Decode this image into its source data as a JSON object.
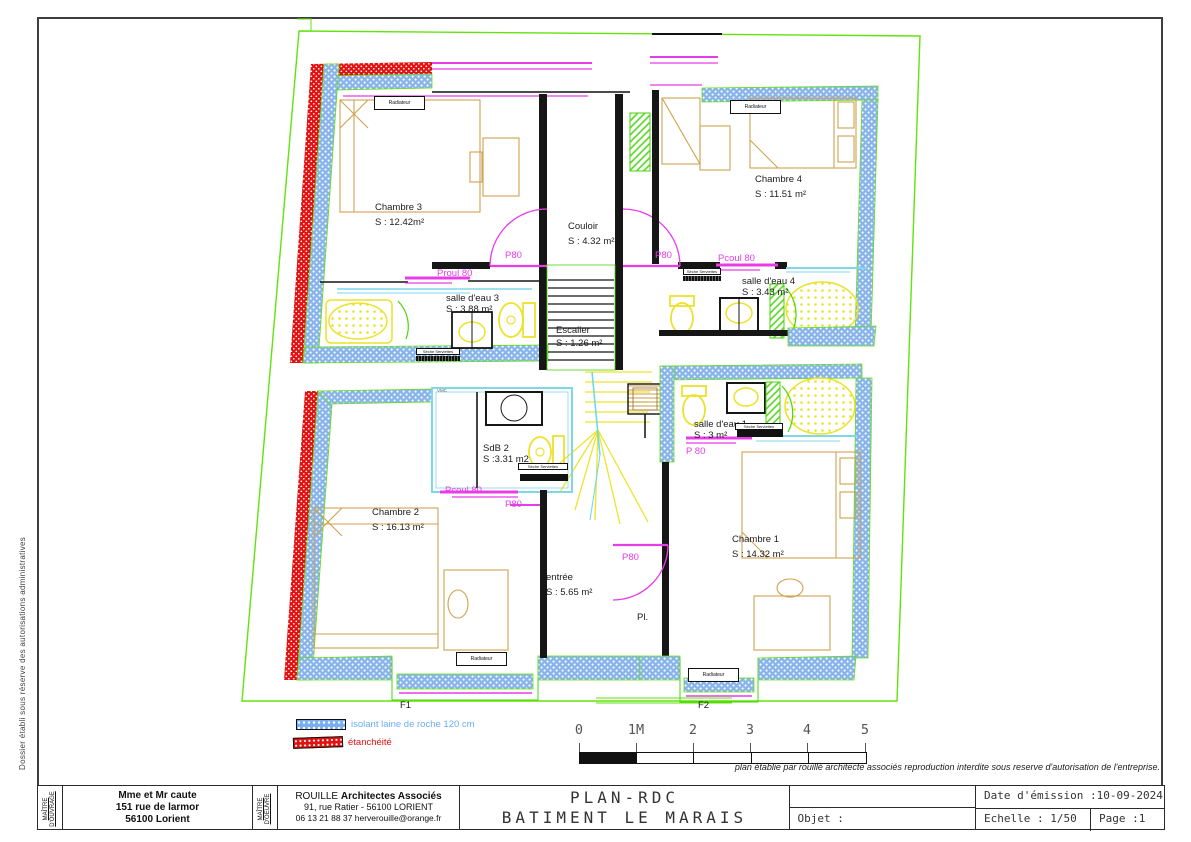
{
  "sheet": {
    "side_note": "Dossier établi sous réserve des autorisations administratives",
    "copyright": "plan établie par rouillé architecte associés reproduction interdite sous reserve d'autorisation de l'entreprise."
  },
  "rooms": {
    "chambre3": {
      "name": "Chambre 3",
      "area": "S : 12.42m²"
    },
    "chambre4": {
      "name": "Chambre 4",
      "area": "S : 11.51 m²"
    },
    "couloir": {
      "name": "Couloir",
      "area": "S : 4.32 m²"
    },
    "salle_eau_3": {
      "name": "salle d'eau 3",
      "area": "S : 3.88 m²"
    },
    "salle_eau_4": {
      "name": "salle d'eau 4",
      "area": "S : 3.43 m²"
    },
    "escalier": {
      "name": "Escalier",
      "area": "S : 1.26 m²"
    },
    "sdb2": {
      "name": "SdB 2",
      "area": "S :3.31 m2"
    },
    "salle_eau_1": {
      "name": "salle d'eau 1",
      "area": "S : 3 m²"
    },
    "chambre2": {
      "name": "Chambre 2",
      "area": "S : 16.13 m²"
    },
    "chambre1": {
      "name": "Chambre 1",
      "area": "S : 14.32 m²"
    },
    "entree": {
      "name": "entrée",
      "area": "S : 5.65 m²"
    },
    "placard": {
      "name": "Pl."
    }
  },
  "doors": {
    "proul80_left": "Proul 80",
    "p80_upper_left": "P80",
    "p80_upper_right": "P80",
    "pcoul80_upper_right": "Pcoul 80",
    "pcoul80_sdb2": "Pcoul 80",
    "p80_sdb2": "P80",
    "p80_salle_eau_1": "P 80",
    "p80_entree": "P80"
  },
  "equipment": {
    "radiateur": "Radiateur",
    "seche_serviettes": "Sèche Serviettes",
    "vmc": "VMC"
  },
  "windows": {
    "f1": "F1",
    "f2": "F2"
  },
  "legend": {
    "isolant_label": "isolant laine de roche 120 cm",
    "etancheite_label": "étanchéité"
  },
  "colors": {
    "isolant": "#79aef0",
    "etancheite": "#e01212",
    "menuiserie": "#e83ce8",
    "limite_terrain": "#62e30c"
  },
  "scalebar": {
    "ticks": [
      "0",
      "1M",
      "2",
      "3",
      "4",
      "5"
    ]
  },
  "titleblock": {
    "owner_role_1": "MAÎTRE",
    "owner_role_2": "D'OUVRAGE",
    "owner_name": "Mme et Mr caute",
    "owner_addr1": "151 rue de larmor",
    "owner_addr2": "56100 Lorient",
    "architect_role_1": "MAÎTRE",
    "architect_role_2": "D'OEUVRE",
    "architect_name_a": "ROUILLE",
    "architect_name_b": "Architectes Associés",
    "architect_addr": "91, rue Ratier - 56100 LORIENT",
    "architect_contact": "06 13 21 88 37 herverouille@orange.fr",
    "title_line1": "PLAN-RDC",
    "title_line2": "BATIMENT LE MARAIS",
    "objet_label": "Objet :",
    "date_label": "Date d'émission :",
    "date_value": "10-09-2024",
    "echelle_label": "Echelle :",
    "echelle_value": "1/50",
    "page_label": "Page :",
    "page_value": "1"
  }
}
